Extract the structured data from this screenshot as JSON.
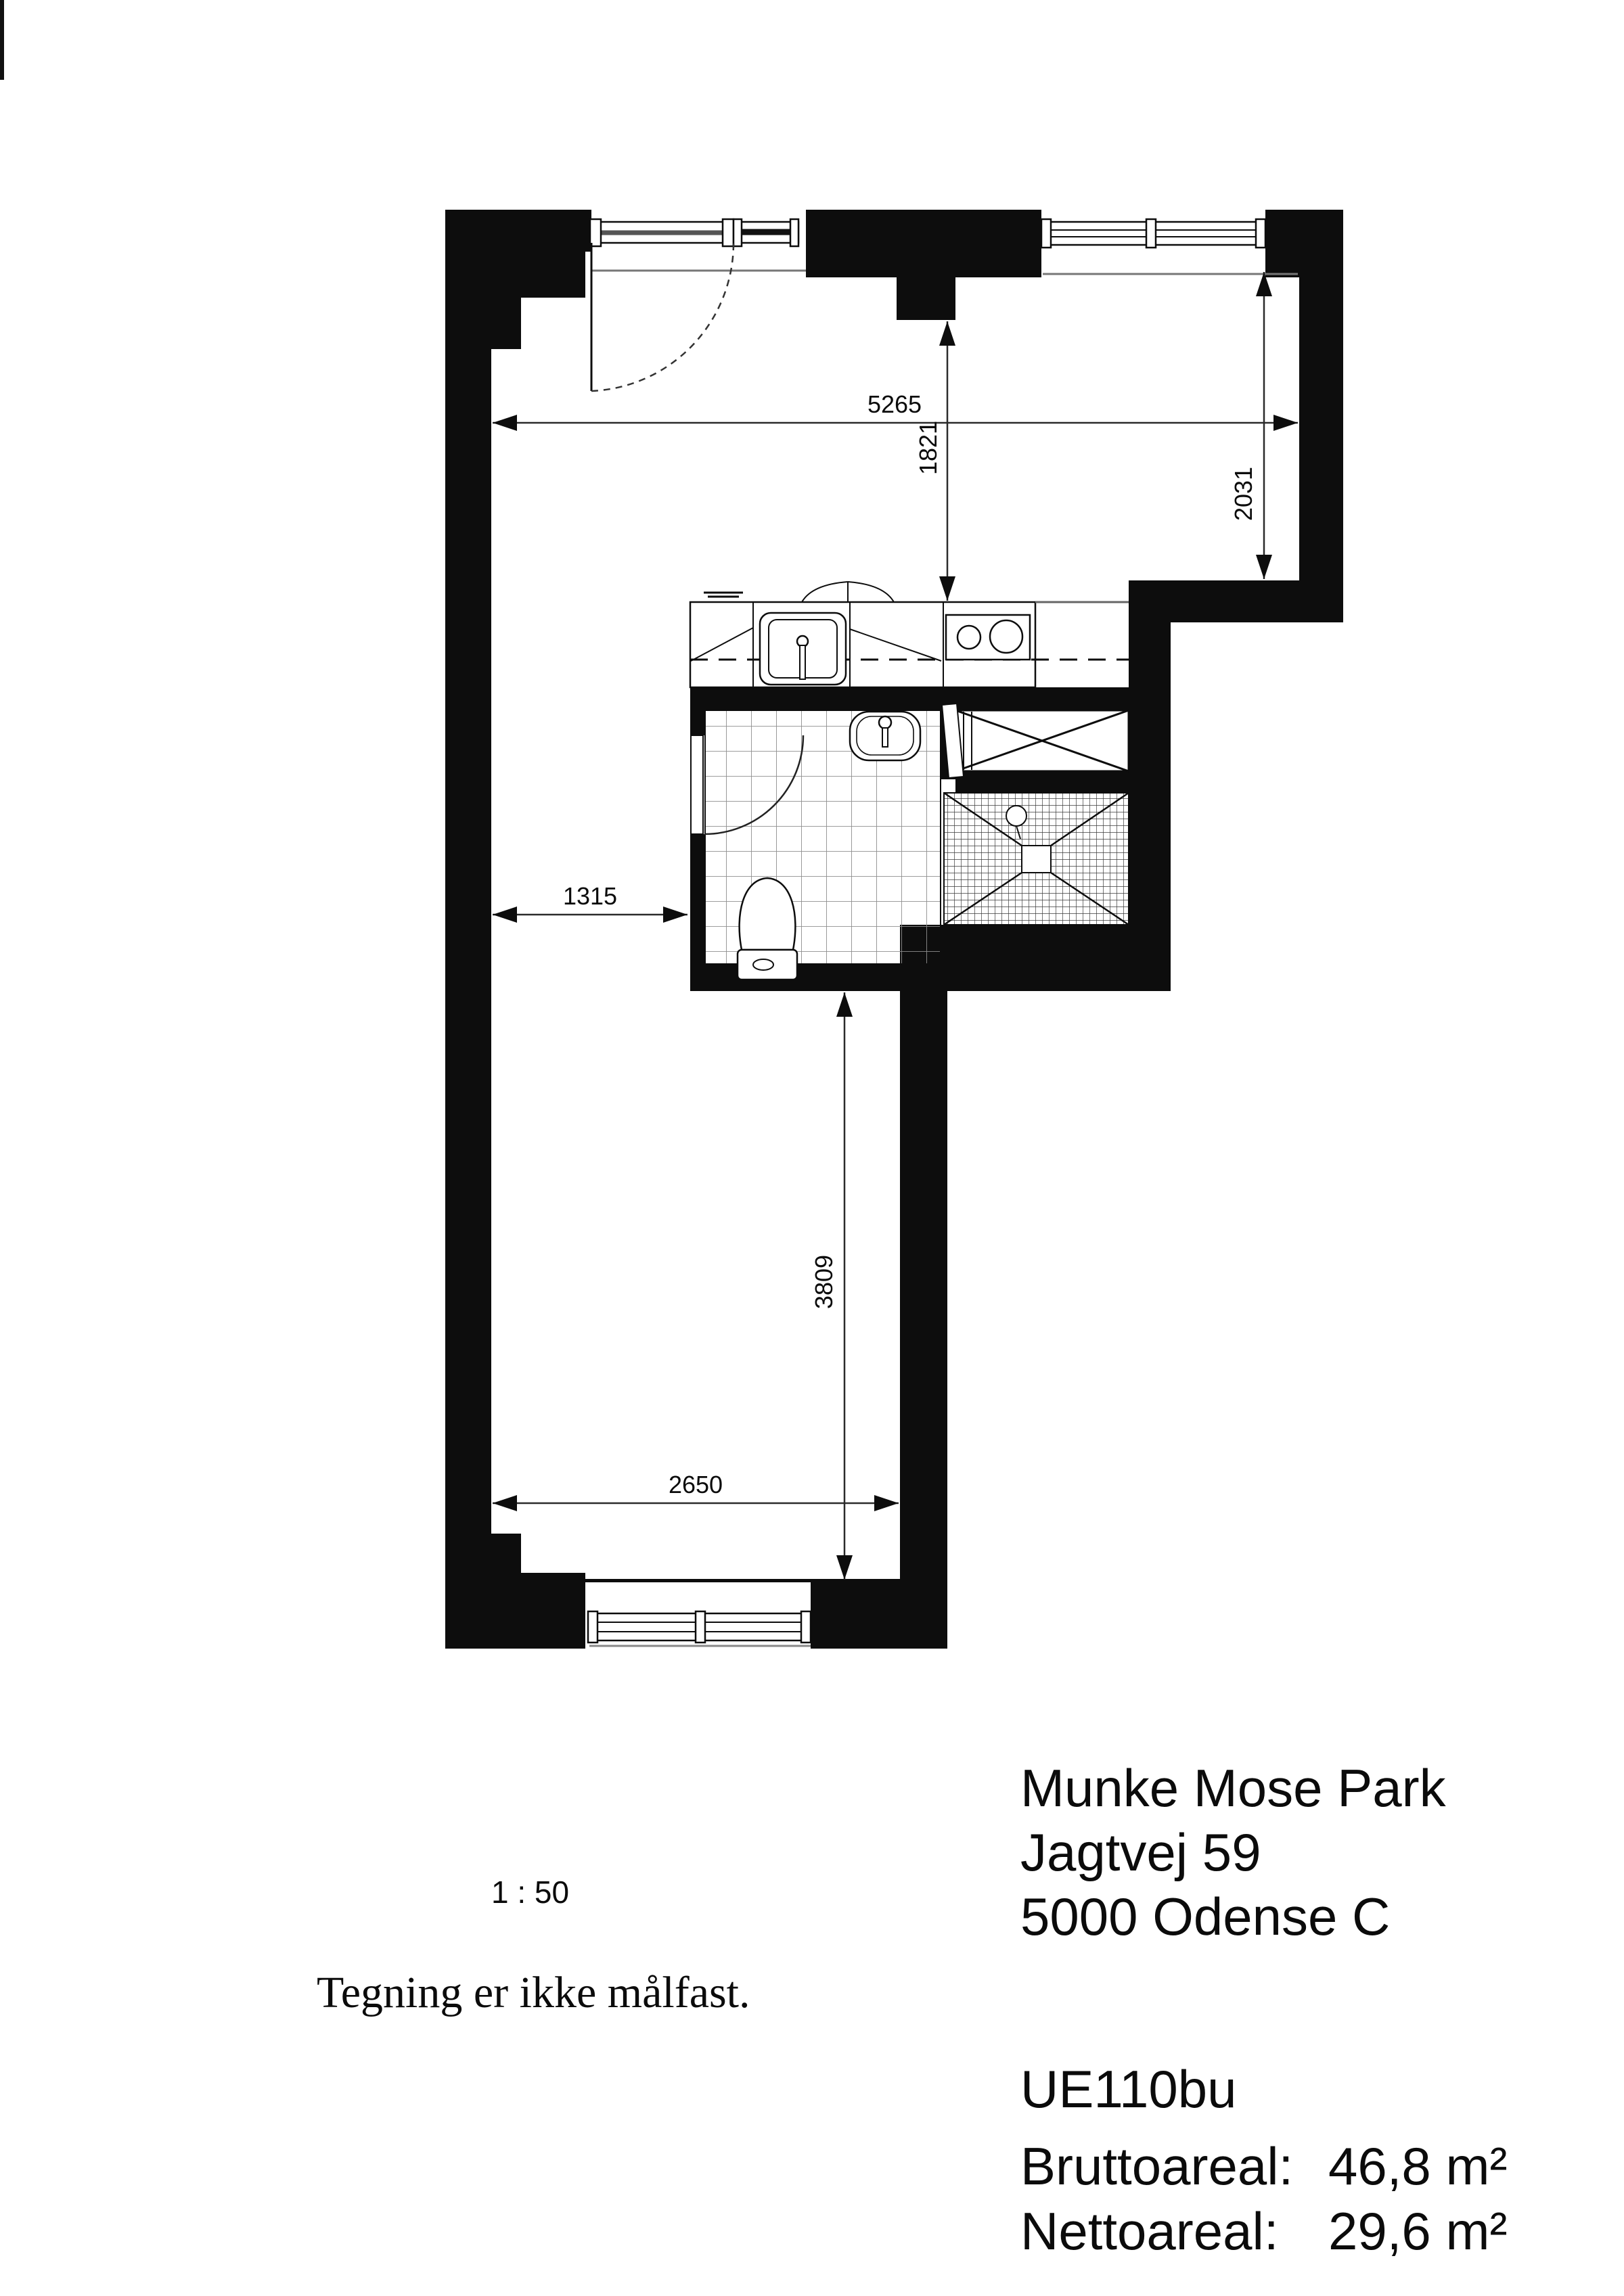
{
  "document": {
    "kind": "floor-plan-drawing"
  },
  "plan": {
    "dimensions_mm": {
      "living_top_width": "5265",
      "kitchen_depth": "1821",
      "right_bay_depth": "2031",
      "hall_width": "1315",
      "lower_room_depth": "3809",
      "lower_room_width": "2650"
    },
    "rooms": [
      "main room",
      "kitchen",
      "bathroom",
      "shower",
      "shaft"
    ],
    "fixtures": [
      "entrance-door",
      "kitchen-sink",
      "stove",
      "wash-basin",
      "toilet",
      "shower-drain",
      "windows"
    ]
  },
  "scale_label": "1 : 50",
  "disclaimer": "Tegning er ikke målfast.",
  "address": {
    "line1": "Munke Mose Park",
    "line2": "Jagtvej 59",
    "line3": "5000 Odense C"
  },
  "unit": {
    "id": "UE110bu",
    "gross_label": "Bruttoareal:",
    "gross_value": "46,8 m²",
    "net_label": "Nettoareal:",
    "net_value": "29,6 m²"
  },
  "colors": {
    "ink": "#0d0d0d",
    "dim_line": "#2b2b2b",
    "light_line": "#777777"
  }
}
